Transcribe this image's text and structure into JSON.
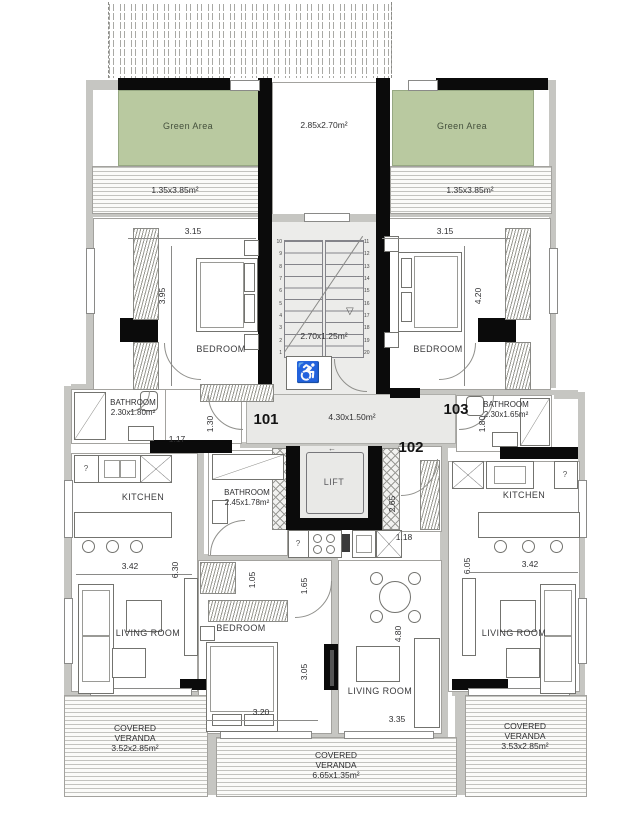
{
  "colors": {
    "green_area": "#b9c9a0",
    "wall_gray": "#c6c6c2",
    "wall_black": "#0b0b0b",
    "floor_gray": "#e9e9e7"
  },
  "stairwell": {
    "terrace_dim": "2.85x2.70m²",
    "stair_dim": "2.70x1.25m²",
    "steps_left": [
      "10",
      "9",
      "8",
      "7",
      "6",
      "5",
      "4",
      "3",
      "2",
      "1"
    ],
    "steps_right": [
      "11",
      "12",
      "13",
      "14",
      "15",
      "16",
      "17",
      "18",
      "19",
      "20"
    ],
    "down_arrow": "▽",
    "lift_label": "LIFT",
    "lift_arrow": "←",
    "wheelchair_icon": "♿"
  },
  "hallway": {
    "dim": "4.30x1.50m²",
    "unit101": "101",
    "unit102": "102",
    "unit103": "103"
  },
  "unit101": {
    "green_area_label": "Green Area",
    "veranda_top_dim": "1.35x3.85m²",
    "bedroom_label": "BEDROOM",
    "bedroom_width": "3.15",
    "bedroom_height": "3.95",
    "wardrobe_depth": "1.30",
    "bath_label": "BATHROOM",
    "bath_dim": "2.30x1.80m²",
    "entry_dim": "1.17",
    "kitchen_label": "KITCHEN",
    "kitchen_width": "3.42",
    "unit_depth": "6.30",
    "living_label": "LIVING ROOM",
    "veranda_line1": "COVERED",
    "veranda_line2": "VERANDA",
    "veranda_dim": "3.52x2.85m²",
    "appliance_mark": "?"
  },
  "unit102": {
    "bath_label": "BATHROOM",
    "bath_dim": "2.45x1.78m²",
    "bedroom_label": "BEDROOM",
    "living_label": "LIVING ROOM",
    "dim_105": "1.05",
    "dim_165": "1.65",
    "dim_305": "3.05",
    "dim_320": "3.20",
    "dim_265": "2.65",
    "dim_118": "1.18",
    "dim_480": "4.80",
    "dim_335": "3.35",
    "veranda_line1": "COVERED",
    "veranda_line2": "VERANDA",
    "veranda_dim": "6.65x1.35m²",
    "appliance_mark": "?"
  },
  "unit103": {
    "green_area_label": "Green Area",
    "veranda_top_dim": "1.35x3.85m²",
    "bedroom_label": "BEDROOM",
    "bedroom_width": "3.15",
    "bedroom_height": "4.20",
    "bath_label": "BATHROOM",
    "bath_dim": "2.30x1.65m²",
    "bath_door_dim": "1.80",
    "kitchen_label": "KITCHEN",
    "kitchen_width": "3.42",
    "unit_depth": "6.05",
    "living_label": "LIVING ROOM",
    "veranda_line1": "COVERED",
    "veranda_line2": "VERANDA",
    "veranda_dim": "3.53x2.85m²",
    "appliance_mark": "?"
  }
}
